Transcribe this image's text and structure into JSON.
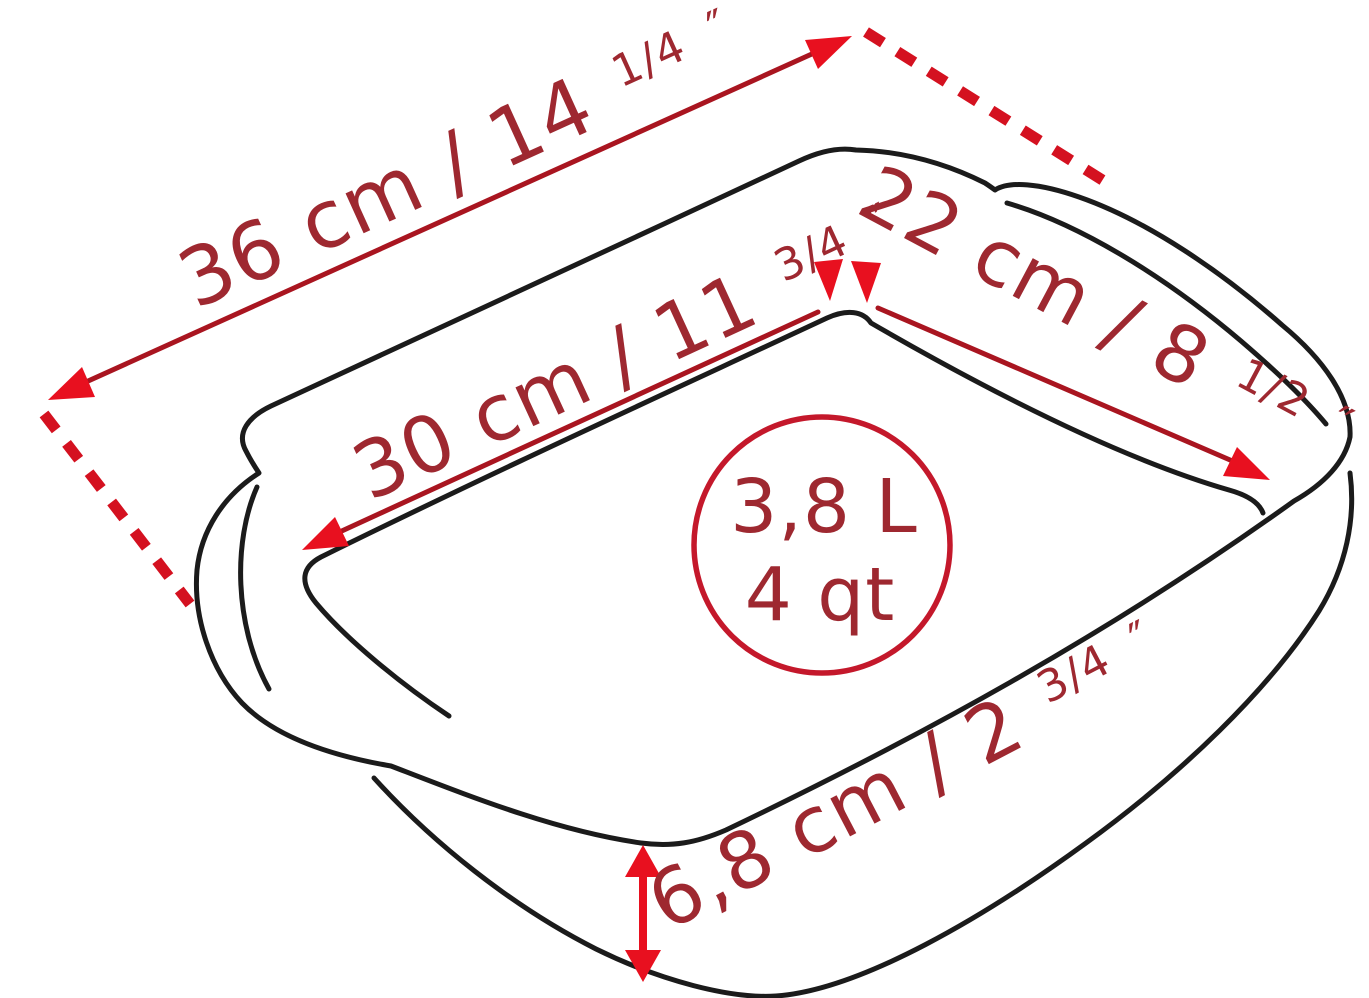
{
  "diagram": {
    "subject": "rectangular-baking-dish-dimension-diagram",
    "colors": {
      "background": "#ffffff",
      "outline": "#1b1b1b",
      "dimension_line": "#a91520",
      "dimension_text": "#9e2830",
      "arrowhead": "#e8101f",
      "extension_dash": "#d41120",
      "capacity_circle": "#c4182b"
    },
    "dimensions": {
      "overall_length": {
        "main": "36 cm / 14",
        "fraction": "1/4",
        "mark": "″",
        "metric": "36 cm",
        "imperial": "14 1/4″",
        "display": "36 cm / 14 1/4″"
      },
      "interior_length": {
        "main": "30 cm / 11",
        "fraction": "3/4",
        "mark": "″",
        "metric": "30 cm",
        "imperial": "11 3/4″",
        "display": "30 cm / 11 3/4″"
      },
      "interior_width": {
        "main": "22 cm / 8",
        "fraction": "1/2",
        "mark": "″",
        "metric": "22 cm",
        "imperial": "8 1/2″",
        "display": "22 cm / 8 1/2″"
      },
      "height": {
        "main": "6,8 cm / 2",
        "fraction": "3/4",
        "mark": "″",
        "metric": "6,8 cm",
        "imperial": "2 3/4″",
        "display": "6,8 cm / 2 3/4″"
      }
    },
    "capacity": {
      "litres": "3,8 L",
      "quarts": "4 qt"
    }
  }
}
